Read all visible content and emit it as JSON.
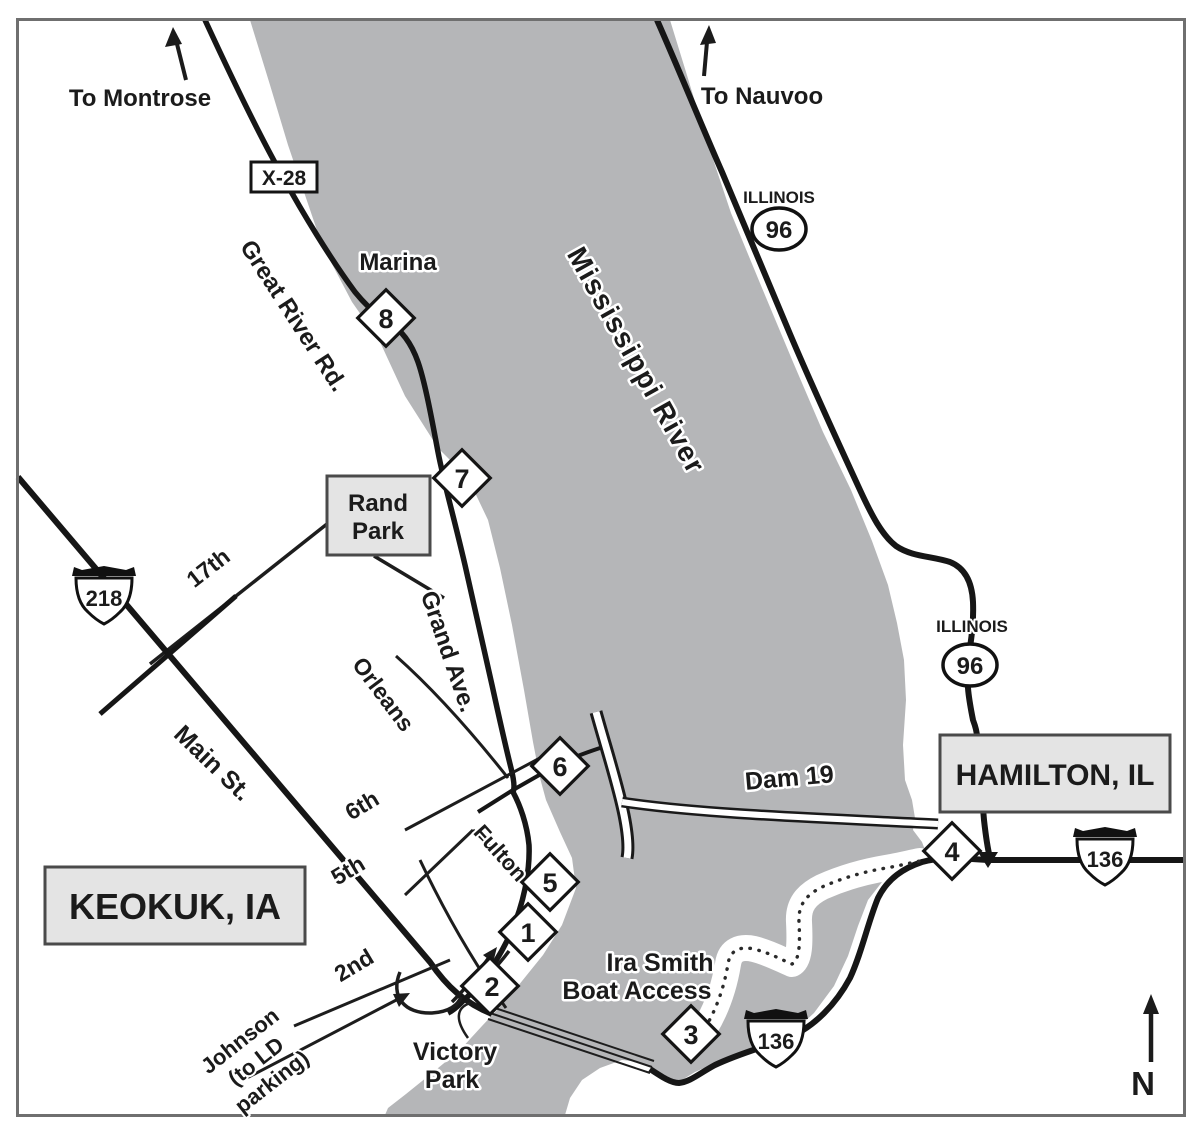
{
  "colors": {
    "river": "#b5b6b8",
    "road": "#161616",
    "box_fill": "#e4e4e4",
    "box_stroke": "#4a4a4a",
    "border": "#6f6f6f"
  },
  "labels": {
    "to_montrose": "To Montrose",
    "to_nauvoo": "To Nauvoo",
    "compass_north": "N",
    "mississippi_river": "Mississippi River",
    "dam": "Dam 19",
    "marina": "Marina",
    "ira_smith_line1": "Ira Smith",
    "ira_smith_line2": "Boat Access",
    "victory_line1": "Victory",
    "victory_line2": "Park",
    "keokuk": "KEOKUK, IA",
    "hamilton": "HAMILTON, IL",
    "rand_line1": "Rand",
    "rand_line2": "Park"
  },
  "streets": {
    "great_river_rd": "Great River Rd.",
    "grand_ave": "Grand Ave.",
    "orleans": "Orleans",
    "main_st": "Main St.",
    "seventeenth": "17th",
    "sixth": "6th",
    "fifth": "5th",
    "fulton": "Fulton",
    "second": "2nd",
    "johnson_line1": "Johnson",
    "johnson_line2": "(to LD",
    "johnson_line3": "parking)"
  },
  "shields": {
    "x28": "X-28",
    "us218": "218",
    "us136": "136",
    "il96": "96",
    "illinois": "ILLINOIS"
  },
  "markers": [
    {
      "number": "1"
    },
    {
      "number": "2"
    },
    {
      "number": "3"
    },
    {
      "number": "4"
    },
    {
      "number": "5"
    },
    {
      "number": "6"
    },
    {
      "number": "7"
    },
    {
      "number": "8"
    }
  ]
}
